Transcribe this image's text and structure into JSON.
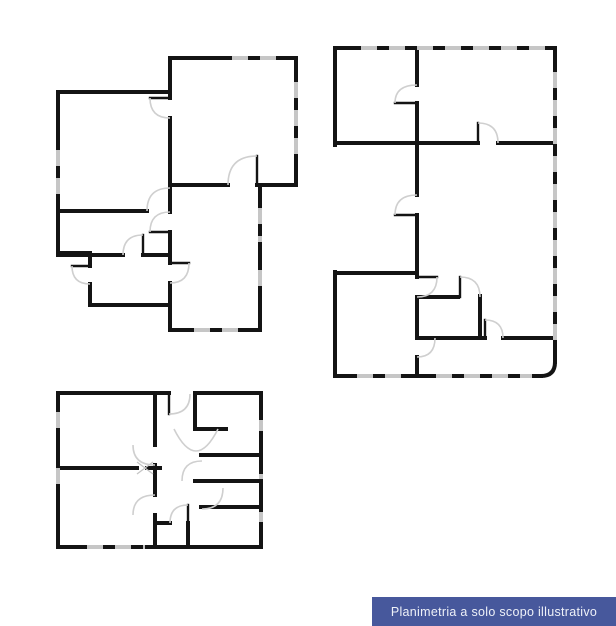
{
  "banner": {
    "label": "Planimetria a solo scopo illustrativo",
    "bg": "#47589c",
    "fg": "#eef1f8"
  },
  "drawing": {
    "wall_color": "#141414",
    "window_color": "#c6c6c6",
    "arc_color": "#cfcfcf",
    "mark_color": "#c4c4c4",
    "wall_width": 4,
    "leaf_width": 2.4,
    "arc_width": 1.6,
    "window_dash": "12 16",
    "plans": [
      {
        "id": "plan-upper-left",
        "walls": [
          [
            170,
            58,
            296,
            58
          ],
          [
            296,
            58,
            296,
            185
          ],
          [
            257,
            185,
            296,
            185
          ],
          [
            170,
            185,
            228,
            185
          ],
          [
            260,
            185,
            260,
            330
          ],
          [
            170,
            330,
            260,
            330
          ],
          [
            170,
            58,
            170,
            98
          ],
          [
            170,
            118,
            170,
            212
          ],
          [
            170,
            232,
            170,
            263
          ],
          [
            170,
            283,
            170,
            330
          ],
          [
            58,
            92,
            170,
            92
          ],
          [
            58,
            92,
            58,
            253
          ],
          [
            58,
            253,
            90,
            253
          ],
          [
            90,
            253,
            90,
            266
          ],
          [
            90,
            284,
            90,
            305
          ],
          [
            90,
            305,
            170,
            305
          ],
          [
            58,
            211,
            147,
            211
          ],
          [
            58,
            255,
            123,
            255
          ],
          [
            143,
            255,
            170,
            255
          ]
        ],
        "windows": [
          [
            220,
            58,
            288,
            58
          ],
          [
            296,
            70,
            296,
            162
          ],
          [
            58,
            138,
            58,
            202
          ],
          [
            260,
            196,
            260,
            242
          ],
          [
            260,
            258,
            260,
            292
          ],
          [
            182,
            330,
            248,
            330
          ]
        ],
        "leaves": [
          [
            150,
            98,
            170,
            98
          ],
          [
            150,
            232,
            170,
            232
          ],
          [
            170,
            263,
            189,
            263
          ],
          [
            143,
            235,
            143,
            255
          ],
          [
            257,
            156,
            257,
            185
          ],
          [
            72,
            266,
            90,
            266
          ]
        ],
        "arcs": [
          "M150,98 Q150,118 170,118",
          "M147,211 Q147,188 170,188",
          "M150,232 Q150,212 170,212",
          "M189,263 Q189,283 170,283",
          "M123,255 Q123,235 143,235",
          "M228,185 Q228,156 257,156",
          "M72,266 Q72,284 90,284"
        ]
      },
      {
        "id": "plan-upper-right",
        "walls": [
          [
            335,
            48,
            555,
            48
          ],
          [
            335,
            48,
            335,
            145
          ],
          [
            335,
            143,
            478,
            143
          ],
          [
            498,
            143,
            555,
            143
          ],
          [
            417,
            48,
            417,
            85
          ],
          [
            417,
            103,
            417,
            195
          ],
          [
            417,
            215,
            417,
            277
          ],
          [
            555,
            48,
            555,
            362
          ],
          [
            335,
            376,
            541,
            376
          ],
          [
            335,
            272,
            335,
            376
          ],
          [
            335,
            273,
            417,
            273
          ],
          [
            417,
            297,
            458,
            297
          ],
          [
            417,
            297,
            417,
            338
          ],
          [
            480,
            296,
            480,
            338
          ],
          [
            417,
            338,
            485,
            338
          ],
          [
            503,
            338,
            555,
            338
          ],
          [
            417,
            357,
            417,
            376
          ]
        ],
        "wall_paths": [
          "M555,362 Q555,376 541,376"
        ],
        "windows": [
          [
            349,
            48,
            546,
            48
          ],
          [
            555,
            60,
            555,
            352
          ],
          [
            345,
            376,
            410,
            376
          ],
          [
            424,
            376,
            532,
            376
          ]
        ],
        "leaves": [
          [
            395,
            103,
            417,
            103
          ],
          [
            395,
            215,
            417,
            215
          ],
          [
            478,
            123,
            478,
            143
          ],
          [
            417,
            277,
            437,
            277
          ],
          [
            460,
            277,
            460,
            297
          ],
          [
            485,
            320,
            485,
            338
          ],
          [
            417,
            338,
            435,
            338
          ]
        ],
        "arcs": [
          "M395,103 Q395,85 417,85",
          "M395,215 Q395,195 417,195",
          "M478,123 Q498,123 498,143",
          "M437,277 Q437,297 417,297",
          "M460,277 Q480,277 480,297",
          "M485,320 Q503,320 503,338",
          "M435,338 Q435,357 417,357"
        ]
      },
      {
        "id": "plan-lower-left",
        "walls": [
          [
            58,
            393,
            169,
            393
          ],
          [
            195,
            393,
            261,
            393
          ],
          [
            58,
            393,
            58,
            547
          ],
          [
            58,
            547,
            261,
            547
          ],
          [
            261,
            393,
            261,
            547
          ],
          [
            155,
            395,
            155,
            445
          ],
          [
            155,
            465,
            155,
            495
          ],
          [
            155,
            515,
            155,
            547
          ],
          [
            58,
            468,
            137,
            468
          ],
          [
            147,
            468,
            160,
            468
          ],
          [
            195,
            393,
            195,
            429
          ],
          [
            195,
            429,
            226,
            429
          ],
          [
            201,
            455,
            261,
            455
          ],
          [
            195,
            481,
            261,
            481
          ],
          [
            201,
            507,
            261,
            507
          ],
          [
            155,
            523,
            170,
            523
          ],
          [
            188,
            523,
            188,
            547
          ]
        ],
        "windows": [
          [
            58,
            400,
            58,
            428
          ],
          [
            58,
            456,
            58,
            490
          ],
          [
            75,
            547,
            145,
            547
          ],
          [
            261,
            408,
            261,
            431
          ],
          [
            261,
            462,
            261,
            479
          ],
          [
            261,
            500,
            261,
            522
          ]
        ],
        "leaves": [
          [
            169,
            393,
            169,
            414
          ],
          [
            188,
            505,
            188,
            523
          ]
        ],
        "arcs": [
          "M169,414 Q190,414 190,394",
          "M155,465 Q133,465 133,445",
          "M155,495 Q133,495 133,515",
          "M174,429 Q196,473 218,429",
          "M188,505 Q170,505 170,523",
          "M202,461 Q182,461 182,481",
          "M202,509 Q223,509 223,488"
        ],
        "marks": [
          [
            137,
            474,
            153,
            462
          ],
          [
            137,
            462,
            153,
            474
          ]
        ]
      }
    ]
  }
}
